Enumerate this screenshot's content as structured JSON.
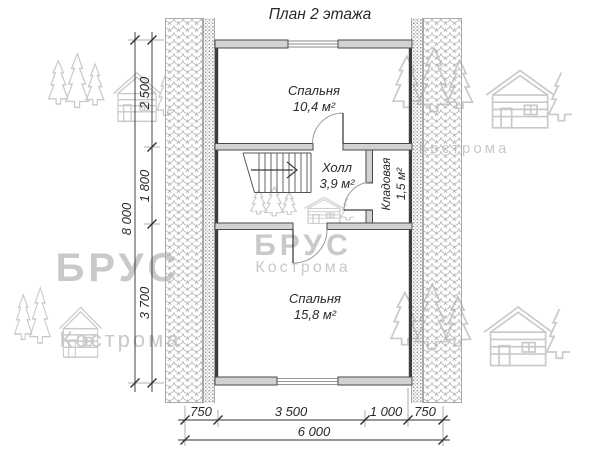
{
  "title": "План 2 этажа",
  "rooms": {
    "bedroom1": {
      "name": "Спальня",
      "area": "10,4 м²"
    },
    "hall": {
      "name": "Холл",
      "area": "3,9 м²"
    },
    "storage": {
      "name": "Кладовая",
      "area": "1,5 м²"
    },
    "bedroom2": {
      "name": "Спальня",
      "area": "15,8 м²"
    }
  },
  "dimensions": {
    "vertical": {
      "total": "8 000",
      "segments": [
        "2 500",
        "1 800",
        "3 700"
      ]
    },
    "horizontal": {
      "total": "6 000",
      "segments": [
        "750",
        "3 500",
        "1 000",
        "750"
      ]
    }
  },
  "watermark": {
    "brand": "БРУС",
    "city": "Кострома"
  }
}
